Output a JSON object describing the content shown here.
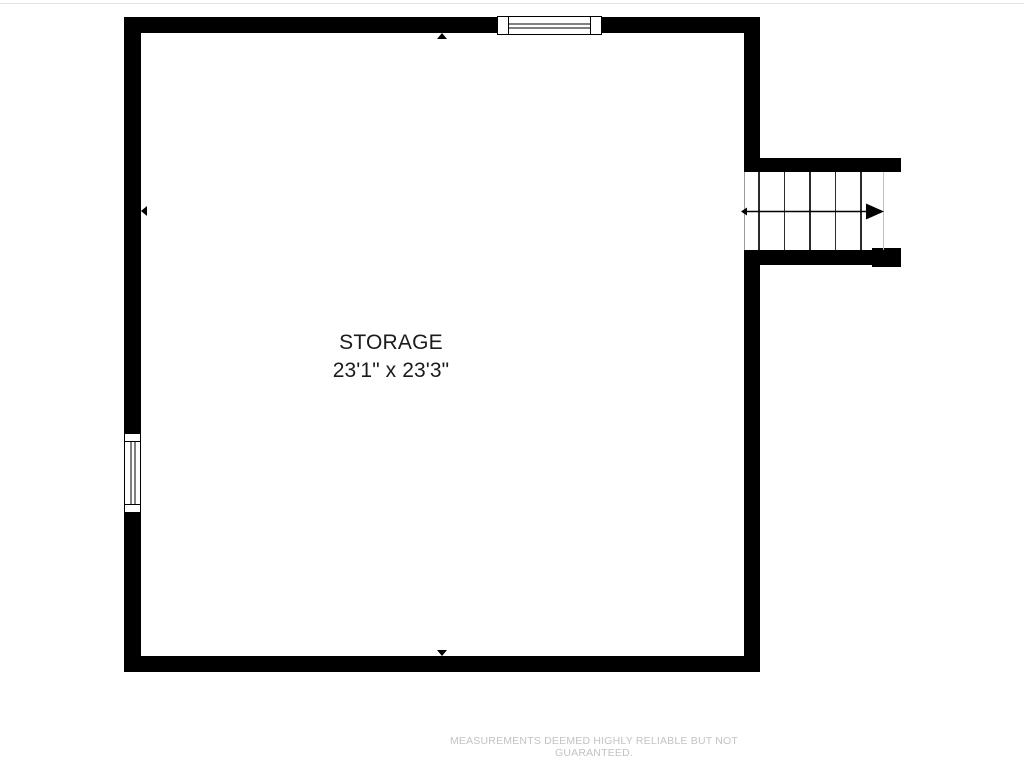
{
  "page": {
    "background": "#ffffff",
    "top_edge_line_color": "#e4e4e4"
  },
  "floorplan": {
    "room": {
      "name": "STORAGE",
      "dimensions": "23'1\" x 23'3\""
    },
    "stairs": {
      "tread_count": 5,
      "direction": "right",
      "arrow_icon": "stair-direction-arrow"
    },
    "windows": [
      {
        "id": "top-window",
        "wall": "top"
      },
      {
        "id": "left-window",
        "wall": "left"
      }
    ],
    "markers": [
      "top-wall-marker",
      "bottom-wall-marker",
      "left-wall-marker"
    ],
    "colors": {
      "wall": "#000000",
      "room_label": "#1b1b1b",
      "tread": "#2b2b2b",
      "stair_edge": "#c0c0c0",
      "arrow": "#000000"
    }
  },
  "footer": {
    "disclaimer": "MEASUREMENTS DEEMED HIGHLY RELIABLE BUT NOT GUARANTEED.",
    "color": "#c3c3c3"
  }
}
